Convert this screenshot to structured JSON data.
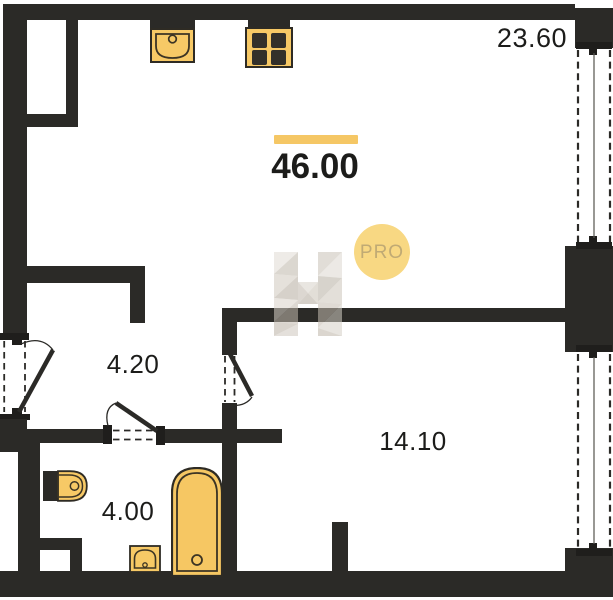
{
  "plan": {
    "areas": {
      "total": "46.00",
      "living_room": "23.60",
      "hallway": "4.20",
      "bedroom": "14.10",
      "bathroom": "4.00"
    },
    "badge": {
      "text": "PRO"
    },
    "watermark_letter": "H",
    "colors": {
      "wall": "#2b2a27",
      "fixture_fill": "#f7c966",
      "fixture_stroke": "#3c3424",
      "accent_bar": "#f5c765",
      "badge_bg": "#f8d883",
      "badge_text": "#c0aa74"
    },
    "fixtures": [
      "kitchen-sink",
      "stove",
      "toilet",
      "bathtub",
      "washbasin"
    ],
    "windows": 2,
    "doors": 3
  }
}
